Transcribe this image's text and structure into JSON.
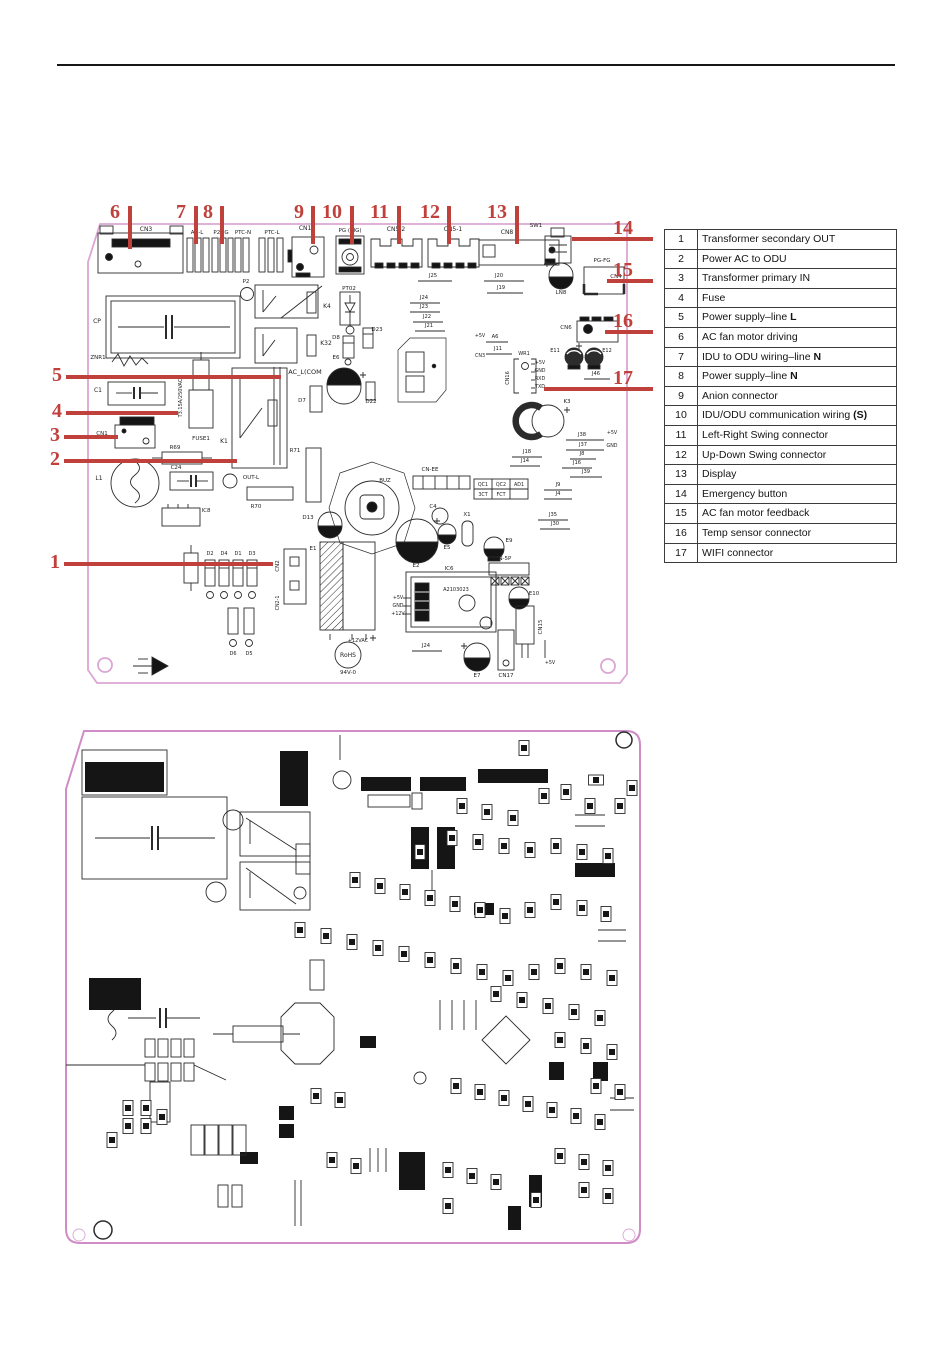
{
  "colors": {
    "callout_red": "#c0403c",
    "board_pink": "#dba6d4",
    "ink": "#2b2b2b"
  },
  "legend": {
    "rows": [
      {
        "num": "1",
        "label": "Transformer secondary OUT",
        "bold": ""
      },
      {
        "num": "2",
        "label": "Power AC to ODU",
        "bold": ""
      },
      {
        "num": "3",
        "label": "Transformer primary IN",
        "bold": ""
      },
      {
        "num": "4",
        "label": "Fuse",
        "bold": ""
      },
      {
        "num": "5",
        "label": "Power supply–line ",
        "bold": "L"
      },
      {
        "num": "6",
        "label": "AC fan motor driving",
        "bold": ""
      },
      {
        "num": "7",
        "label": "IDU to ODU wiring–line ",
        "bold": "N"
      },
      {
        "num": "8",
        "label": "Power supply–line ",
        "bold": "N"
      },
      {
        "num": "9",
        "label": "Anion connector",
        "bold": ""
      },
      {
        "num": "10",
        "label": "IDU/ODU communication wiring ",
        "bold": "(S)"
      },
      {
        "num": "11",
        "label": "Left-Right Swing connector",
        "bold": ""
      },
      {
        "num": "12",
        "label": "Up-Down Swing connector",
        "bold": ""
      },
      {
        "num": "13",
        "label": "Display",
        "bold": ""
      },
      {
        "num": "14",
        "label": "Emergency button",
        "bold": ""
      },
      {
        "num": "15",
        "label": "AC fan motor feedback",
        "bold": ""
      },
      {
        "num": "16",
        "label": "Temp sensor connector",
        "bold": ""
      },
      {
        "num": "17",
        "label": "WIFI connector",
        "bold": ""
      }
    ]
  },
  "callouts": {
    "top": [
      {
        "n": "6",
        "num_x": 110,
        "num_y": 202,
        "tick_x": 128,
        "tick_y1": 206,
        "tick_y2": 249
      },
      {
        "n": "7",
        "num_x": 176,
        "num_y": 202,
        "tick_x": 194,
        "tick_y1": 206,
        "tick_y2": 244
      },
      {
        "n": "8",
        "num_x": 203,
        "num_y": 202,
        "tick_x": 220,
        "tick_y1": 206,
        "tick_y2": 244
      },
      {
        "n": "9",
        "num_x": 294,
        "num_y": 202,
        "tick_x": 311,
        "tick_y1": 206,
        "tick_y2": 244
      },
      {
        "n": "10",
        "num_x": 322,
        "num_y": 202,
        "tick_x": 350,
        "tick_y1": 206,
        "tick_y2": 244
      },
      {
        "n": "11",
        "num_x": 370,
        "num_y": 202,
        "tick_x": 397,
        "tick_y1": 206,
        "tick_y2": 244
      },
      {
        "n": "12",
        "num_x": 420,
        "num_y": 202,
        "tick_x": 447,
        "tick_y1": 206,
        "tick_y2": 244
      },
      {
        "n": "13",
        "num_x": 487,
        "num_y": 202,
        "tick_x": 515,
        "tick_y1": 206,
        "tick_y2": 244
      }
    ],
    "left": [
      {
        "n": "5",
        "num_x": 52,
        "num_y": 365,
        "y": 377,
        "x1": 66,
        "x2": 281
      },
      {
        "n": "4",
        "num_x": 52,
        "num_y": 401,
        "y": 413,
        "x1": 66,
        "x2": 178
      },
      {
        "n": "3",
        "num_x": 50,
        "num_y": 425,
        "y": 437,
        "x1": 64,
        "x2": 118
      },
      {
        "n": "2",
        "num_x": 50,
        "num_y": 449,
        "y": 461,
        "x1": 64,
        "x2": 237
      },
      {
        "n": "1",
        "num_x": 50,
        "num_y": 552,
        "y": 564,
        "x1": 64,
        "x2": 273
      }
    ],
    "right": [
      {
        "n": "14",
        "num_x": 613,
        "num_y": 218,
        "y": 239,
        "x1": 572,
        "x2": 653
      },
      {
        "n": "15",
        "num_x": 613,
        "num_y": 260,
        "y": 281,
        "x1": 607,
        "x2": 653
      },
      {
        "n": "16",
        "num_x": 613,
        "num_y": 311,
        "y": 332,
        "x1": 605,
        "x2": 653
      },
      {
        "n": "17",
        "num_x": 613,
        "num_y": 368,
        "y": 389,
        "x1": 544,
        "x2": 653
      }
    ]
  },
  "pcb_top": {
    "labels": [
      [
        "CN3",
        146,
        231,
        6
      ],
      [
        "AC-L",
        197,
        234,
        5.5
      ],
      [
        "P2NG",
        221,
        234,
        5.5
      ],
      [
        "PTC-N",
        243,
        234,
        5.5
      ],
      [
        "PTC-L",
        272,
        234,
        5.5
      ],
      [
        "CN11",
        307,
        230,
        6
      ],
      [
        "PG (SIG)",
        350,
        232,
        5.5
      ],
      [
        "CN5-2",
        396,
        231,
        6
      ],
      [
        "CN5-1",
        453,
        231,
        6
      ],
      [
        "CN8",
        507,
        234,
        6
      ],
      [
        "SW1",
        536,
        227,
        5.5
      ],
      [
        "LN8",
        561,
        294,
        5.5
      ],
      [
        "PG-FG",
        602,
        262,
        5.5
      ],
      [
        "CN4",
        616,
        278,
        5.5
      ],
      [
        "CP",
        97,
        323,
        6
      ],
      [
        "P2",
        246,
        283,
        5.5
      ],
      [
        "K4",
        327,
        308,
        6
      ],
      [
        "K32",
        326,
        345,
        6
      ],
      [
        "PT02",
        349,
        290,
        5.5
      ],
      [
        "D8",
        336,
        339,
        5.5
      ],
      [
        "D23",
        377,
        331,
        5.5
      ],
      [
        "D22",
        371,
        403,
        5.5
      ],
      [
        "E6",
        336,
        359,
        5.5
      ],
      [
        "D7",
        302,
        402,
        5.5
      ],
      [
        "AC_L(COM",
        305,
        374,
        6.5
      ],
      [
        "ZNR1",
        98,
        359,
        5.5
      ],
      [
        "C1",
        98,
        392,
        6
      ],
      [
        "T3.15A/250VAC",
        182,
        398,
        5,
        -90
      ],
      [
        "FUSE1",
        201,
        440,
        5.5
      ],
      [
        "CN1",
        102,
        435,
        5.5
      ],
      [
        "K1",
        224,
        443,
        6
      ],
      [
        "R69",
        175,
        449,
        5.5
      ],
      [
        "C24",
        176,
        469,
        5.5
      ],
      [
        "L1",
        99,
        480,
        6
      ],
      [
        "IC8",
        206,
        512,
        5.5
      ],
      [
        "R70",
        256,
        508,
        5.5
      ],
      [
        "OUT-L",
        251,
        479,
        5.5
      ],
      [
        "R71",
        295,
        452,
        5.5
      ],
      [
        "R13",
        167,
        566,
        5.5
      ],
      [
        "D2",
        210,
        555,
        5
      ],
      [
        "D4",
        224,
        555,
        5
      ],
      [
        "D1",
        238,
        555,
        5
      ],
      [
        "D3",
        252,
        555,
        5
      ],
      [
        "D6",
        233,
        655,
        5
      ],
      [
        "D5",
        249,
        655,
        5
      ],
      [
        "CN2",
        279,
        566,
        5.5,
        -90
      ],
      [
        "CN2-1",
        279,
        603,
        4.8,
        -90
      ],
      [
        "E1",
        313,
        550,
        5.5
      ],
      [
        "+12VAC",
        358,
        642,
        5
      ],
      [
        "RoHS",
        348,
        657,
        6
      ],
      [
        "94V-0",
        348,
        674,
        5.5
      ],
      [
        "BUZ",
        385,
        482,
        5.5
      ],
      [
        "D13",
        308,
        519,
        5.5
      ],
      [
        "E2",
        416,
        567,
        5.5
      ],
      [
        "C4",
        433,
        508,
        5.5
      ],
      [
        "E5",
        447,
        549,
        5.5
      ],
      [
        "X1",
        467,
        516,
        5.5
      ],
      [
        "E9",
        509,
        542,
        5.5
      ],
      [
        "CN-EE",
        430,
        471,
        5.5
      ],
      [
        "QC1",
        483,
        486,
        4.8
      ],
      [
        "QC2",
        501,
        486,
        4.8
      ],
      [
        "AD1",
        519,
        486,
        4.8
      ],
      [
        "3CT",
        483,
        496,
        4.8
      ],
      [
        "FCT",
        501,
        496,
        4.8
      ],
      [
        "CN-5P",
        503,
        560,
        5.5
      ],
      [
        "E10",
        534,
        595,
        5.5
      ],
      [
        "CN15",
        542,
        627,
        5.5,
        -90
      ],
      [
        "IC6",
        449,
        570,
        5.5
      ],
      [
        "A2103023",
        456,
        591,
        5
      ],
      [
        "+5V",
        398,
        599,
        4.8
      ],
      [
        "GND",
        398,
        607,
        4.8
      ],
      [
        "+12V",
        398,
        615,
        4.8
      ],
      [
        "E7",
        477,
        677,
        5.5
      ],
      [
        "CN17",
        506,
        677,
        5.5
      ],
      [
        "+5V",
        550,
        664,
        4.8
      ],
      [
        "J24",
        426,
        647,
        5.2
      ],
      [
        "CN6",
        566,
        329,
        5.5
      ],
      [
        "E11",
        555,
        352,
        5
      ],
      [
        "E12",
        607,
        352,
        5
      ],
      [
        "J46",
        596,
        375,
        5.2
      ],
      [
        "K3",
        567,
        403,
        5.5
      ],
      [
        "WR1",
        524,
        355,
        5
      ],
      [
        "CN16",
        509,
        378,
        5,
        -90
      ],
      [
        "+5V",
        540,
        364,
        4.8
      ],
      [
        "GND",
        540,
        372,
        4.8
      ],
      [
        "RXD",
        540,
        380,
        4.8
      ],
      [
        "TXD",
        540,
        388,
        4.8
      ],
      [
        "J25",
        433,
        277,
        5.2
      ],
      [
        "J20",
        499,
        277,
        5.2
      ],
      [
        "J19",
        501,
        289,
        5.2
      ],
      [
        "J24",
        424,
        299,
        5.2
      ],
      [
        "J23",
        424,
        308,
        5.2
      ],
      [
        "J22",
        427,
        318,
        5.2
      ],
      [
        "J21",
        429,
        327,
        5.2
      ],
      [
        "+5V",
        480,
        337,
        4.8
      ],
      [
        "A6",
        495,
        338,
        5.2
      ],
      [
        "J11",
        498,
        350,
        5.2
      ],
      [
        "CN3",
        480,
        357,
        4.8
      ],
      [
        "J38",
        582,
        436,
        5.2
      ],
      [
        "+5V",
        612,
        434,
        4.8
      ],
      [
        "J37",
        583,
        446,
        5.2
      ],
      [
        "GND",
        612,
        447,
        4.8
      ],
      [
        "J18",
        527,
        453,
        5.2
      ],
      [
        "J8",
        582,
        455,
        5.2
      ],
      [
        "J14",
        525,
        462,
        5.2
      ],
      [
        "J16",
        577,
        464,
        5.2
      ],
      [
        "J39",
        586,
        473,
        5.2
      ],
      [
        "J9",
        558,
        486,
        5.2
      ],
      [
        "J4",
        558,
        495,
        5.2
      ],
      [
        "J35",
        553,
        516,
        5.2
      ],
      [
        "J30",
        555,
        525,
        5.2
      ]
    ]
  }
}
